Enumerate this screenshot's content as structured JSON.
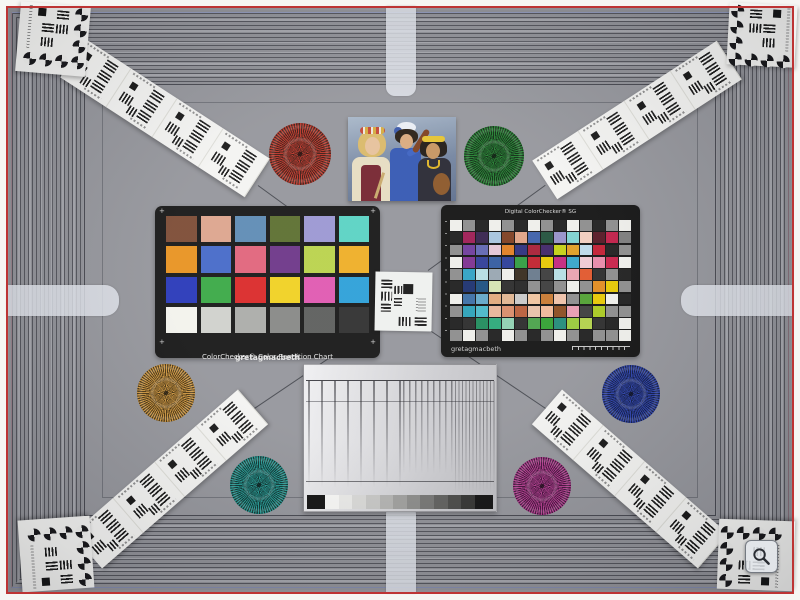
{
  "scene_colors": {
    "background_gray": "#94959b",
    "border_white": "#f6f6f3",
    "frame_red": "#bd3434",
    "stripe_dark": "#3a3b43",
    "tongue_light": "#e2e5ed"
  },
  "colorchecker": {
    "brand": "gretagmacbeth",
    "title": "ColorChecker® Color Rendition Chart",
    "corner_mark": "+",
    "patches": [
      [
        "#7b4a33",
        "#dca48c",
        "#5d8ab4",
        "#5a6e2e",
        "#9a96d2",
        "#58d2c2"
      ],
      [
        "#e8921f",
        "#4468c8",
        "#e0637a",
        "#6b3487",
        "#b9d24a",
        "#eead24"
      ],
      [
        "#2636b8",
        "#38a844",
        "#da2727",
        "#f0d020",
        "#df57b0",
        "#2b9fd8"
      ],
      [
        "#f2f2ec",
        "#cfd0cc",
        "#aaaba8",
        "#868785",
        "#5b5c5b",
        "#2e2e2e"
      ]
    ]
  },
  "sg": {
    "title": "Digital ColorChecker® SG",
    "brand": "gretagmacbeth",
    "patches": [
      [
        "#eeeeea",
        "#8b8b8b",
        "#1d1d1d",
        "#eeeeea",
        "#8b8b8b",
        "#1d1d1d",
        "#eeeeea",
        "#8b8b8b",
        "#1d1d1d",
        "#eeeeea",
        "#8b8b8b",
        "#1d1d1d",
        "#8b8b8b",
        "#eeeeea"
      ],
      [
        "#1d1d1d",
        "#9d1b53",
        "#34204b",
        "#a6c3dd",
        "#7d3d1f",
        "#dfa284",
        "#3c5fa9",
        "#20503a",
        "#9590c8",
        "#7cd1cf",
        "#f1ccbd",
        "#541421",
        "#c01c46",
        "#7b7b7b"
      ],
      [
        "#8b8b8b",
        "#6e3b9b",
        "#6065b2",
        "#e3c5d4",
        "#df7d21",
        "#2b2f7d",
        "#a81e34",
        "#3e2366",
        "#c3cf11",
        "#e09c20",
        "#bcd8e8",
        "#c01b30",
        "#1d1d1d",
        "#8b8b8b"
      ],
      [
        "#eeeeea",
        "#7c2f90",
        "#2e3c96",
        "#31599e",
        "#2a3c97",
        "#2f9b3f",
        "#c0202c",
        "#e6c700",
        "#c2247d",
        "#34a3c8",
        "#eec9d2",
        "#e888a8",
        "#c81f48",
        "#eeeeea"
      ],
      [
        "#8b8b8b",
        "#2ea0c3",
        "#b5dde2",
        "#97a5b0",
        "#eeeeea",
        "#35291c",
        "#67788a",
        "#3a3a3a",
        "#b5dde2",
        "#e8a0ae",
        "#e0552a",
        "#2a2a2a",
        "#8b8b8b",
        "#1d1d1d"
      ],
      [
        "#1d1d1d",
        "#1a2f6e",
        "#1b4f7e",
        "#d5e3b0",
        "#2a2a2a",
        "#232323",
        "#8b8b8b",
        "#3a3a3a",
        "#8b8b8b",
        "#eeeeea",
        "#8b8b8b",
        "#e08a1e",
        "#e6c700",
        "#8b8b8b"
      ],
      [
        "#eeeeea",
        "#3a6ea5",
        "#62a7c8",
        "#e0a87a",
        "#dfb48f",
        "#c8c8c8",
        "#f0c49e",
        "#c87830",
        "#eec0a8",
        "#8b8b8b",
        "#4f9f30",
        "#e6c700",
        "#eeeeea",
        "#1d1d1d"
      ],
      [
        "#8b8b8b",
        "#2aa0b8",
        "#48b8c8",
        "#e8b498",
        "#d88a68",
        "#b85c38",
        "#e8c0a8",
        "#f0b898",
        "#8a4a1e",
        "#e89ab0",
        "#3a3a3a",
        "#a8c81e",
        "#8b8b8b",
        "#8b8b8b"
      ],
      [
        "#1d1d1d",
        "#2a2a2a",
        "#1e8a5a",
        "#2aa878",
        "#8ed0b0",
        "#2a2a2a",
        "#48a048",
        "#30a030",
        "#208a78",
        "#98c838",
        "#b0d048",
        "#2a2a2a",
        "#1d1d1d",
        "#eeeeea"
      ],
      [
        "#8b8b8b",
        "#eeeeea",
        "#8b8b8b",
        "#1d1d1d",
        "#eeeeea",
        "#8b8b8b",
        "#1d1d1d",
        "#8b8b8b",
        "#eeeeea",
        "#8b8b8b",
        "#1d1d1d",
        "#8b8b8b",
        "#8b8b8b",
        "#eeeeea"
      ]
    ]
  },
  "scene": {
    "stars": [
      {
        "id": "red",
        "color": "#b83226",
        "gap": "#3f1a12",
        "cx": 300,
        "cy": 154,
        "r": 31
      },
      {
        "id": "green",
        "color": "#1f7f2d",
        "gap": "#0c2a10",
        "cx": 494,
        "cy": 156,
        "r": 30
      },
      {
        "id": "orange",
        "color": "#c9923c",
        "gap": "#4a3410",
        "cx": 166,
        "cy": 393,
        "r": 29
      },
      {
        "id": "blue",
        "color": "#2a3fa8",
        "gap": "#0f1a46",
        "cx": 631,
        "cy": 394,
        "r": 29
      },
      {
        "id": "teal",
        "color": "#22958f",
        "gap": "#0b3330",
        "cx": 259,
        "cy": 485,
        "r": 29
      },
      {
        "id": "magenta",
        "color": "#b03a8c",
        "gap": "#43103a",
        "cx": 542,
        "cy": 486,
        "r": 29
      }
    ],
    "strips": [
      {
        "id": "top-left",
        "cx": 165,
        "cy": 118,
        "rot": 33
      },
      {
        "id": "top-right",
        "cx": 637,
        "cy": 120,
        "rot": -33
      },
      {
        "id": "bottom-left",
        "cx": 170,
        "cy": 479,
        "rot": -41
      },
      {
        "id": "bottom-right",
        "cx": 630,
        "cy": 479,
        "rot": 41
      }
    ],
    "corner_targets": [
      {
        "id": "top-left",
        "x": 18,
        "y": 4,
        "w": 70,
        "h": 70,
        "rot": 5,
        "flip": "x"
      },
      {
        "id": "top-right",
        "x": 728,
        "y": 4,
        "w": 68,
        "h": 62,
        "rot": 3,
        "flip": "none"
      },
      {
        "id": "bottom-left",
        "x": 20,
        "y": 518,
        "w": 72,
        "h": 72,
        "rot": -4,
        "flip": "xy"
      },
      {
        "id": "bottom-right",
        "x": 718,
        "y": 520,
        "w": 76,
        "h": 70,
        "rot": 2,
        "flip": "y"
      }
    ],
    "hairlines": [
      {
        "x": 258,
        "y": 185,
        "len": 144,
        "rot": 36
      },
      {
        "x": 428,
        "y": 270,
        "len": 145,
        "rot": -36
      },
      {
        "x": 247,
        "y": 413,
        "len": 150,
        "rot": -34
      },
      {
        "x": 430,
        "y": 330,
        "len": 148,
        "rot": 34
      }
    ]
  },
  "sweep": {
    "wedge_steps": [
      "#f7f7f5",
      "#e9e9e7",
      "#d8d8d6",
      "#c6c6c4",
      "#b2b2b0",
      "#9e9e9c",
      "#8a8a88",
      "#747472",
      "#5e5e5c",
      "#484846",
      "#323230"
    ],
    "wedge_cap": "#101010"
  },
  "overlay": {
    "zoom_icon": "magnifier-icon"
  }
}
